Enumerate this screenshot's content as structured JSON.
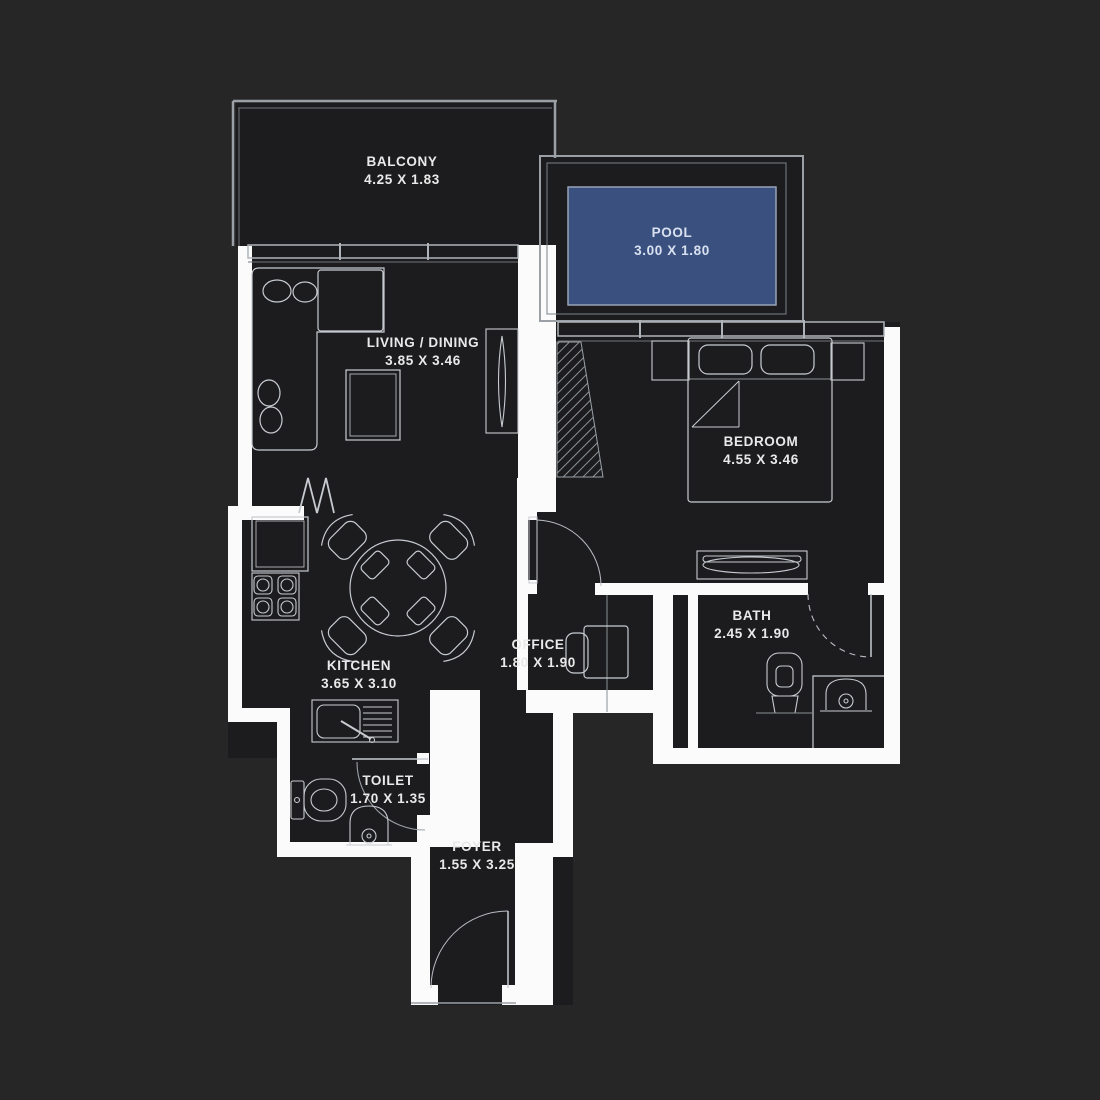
{
  "plan": {
    "type": "apartment-floor-plan",
    "colors": {
      "background": "#262626",
      "floor": "#1c1c1e",
      "wall": "#fbfbfb",
      "structure_line": "#9aa0a6",
      "furniture_line": "#c7cbd1",
      "pool_fill": "#3a5180",
      "label_text": "#e9e9e9",
      "pool_label_text": "#d9e1f0"
    }
  },
  "rooms": [
    {
      "name": "BALCONY",
      "dims": "4.25 X 1.83"
    },
    {
      "name": "POOL",
      "dims": "3.00 X 1.80"
    },
    {
      "name": "LIVING / DINING",
      "dims": "3.85 X 3.46"
    },
    {
      "name": "BEDROOM",
      "dims": "4.55 X 3.46"
    },
    {
      "name": "KITCHEN",
      "dims": "3.65 X 3.10"
    },
    {
      "name": "OFFICE",
      "dims": "1.80 X 1.90"
    },
    {
      "name": "BATH",
      "dims": "2.45 X 1.90"
    },
    {
      "name": "TOILET",
      "dims": "1.70 X 1.35"
    },
    {
      "name": "FOYER",
      "dims": "1.55 X 3.25"
    }
  ]
}
